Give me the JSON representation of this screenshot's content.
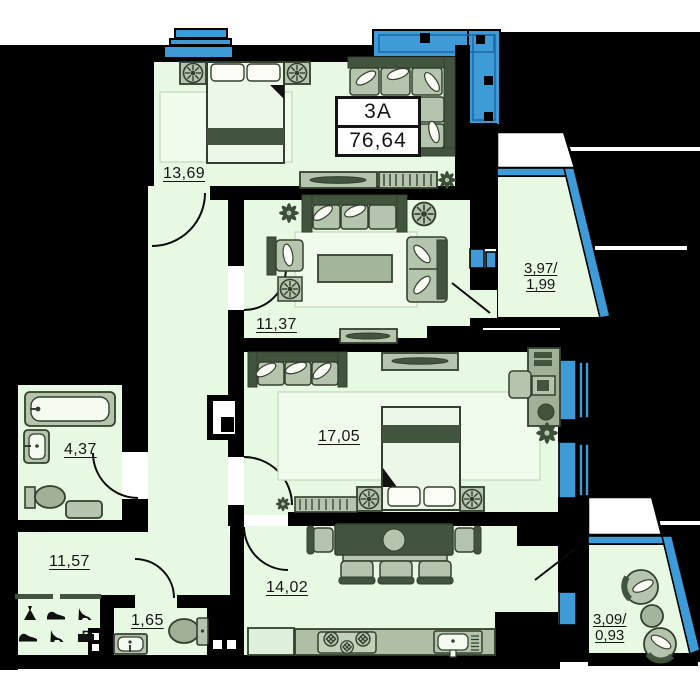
{
  "unit": {
    "code": "3A",
    "total_area": "76,64"
  },
  "rooms": {
    "bedroom1": {
      "area": "13,69"
    },
    "living": {
      "area": "11,37"
    },
    "bedroom2": {
      "area": "17,05"
    },
    "bathroom": {
      "area": "4,37"
    },
    "hallway": {
      "area": "11,57"
    },
    "wc": {
      "area": "1,65"
    },
    "kitchen": {
      "area": "14,02"
    },
    "loggia_right": {
      "area_full": "3,97/",
      "area_counted": "1,99"
    },
    "loggia_bottom": {
      "area_full": "3,09/",
      "area_counted": "0,93"
    }
  },
  "colors": {
    "floor": "#e7f8e3",
    "rug": "#f0fbec",
    "furniture_light": "#b5c4ac",
    "furniture_dark": "#42533e",
    "glazing_blue": "#3e9bd8",
    "wall": "#000000"
  }
}
